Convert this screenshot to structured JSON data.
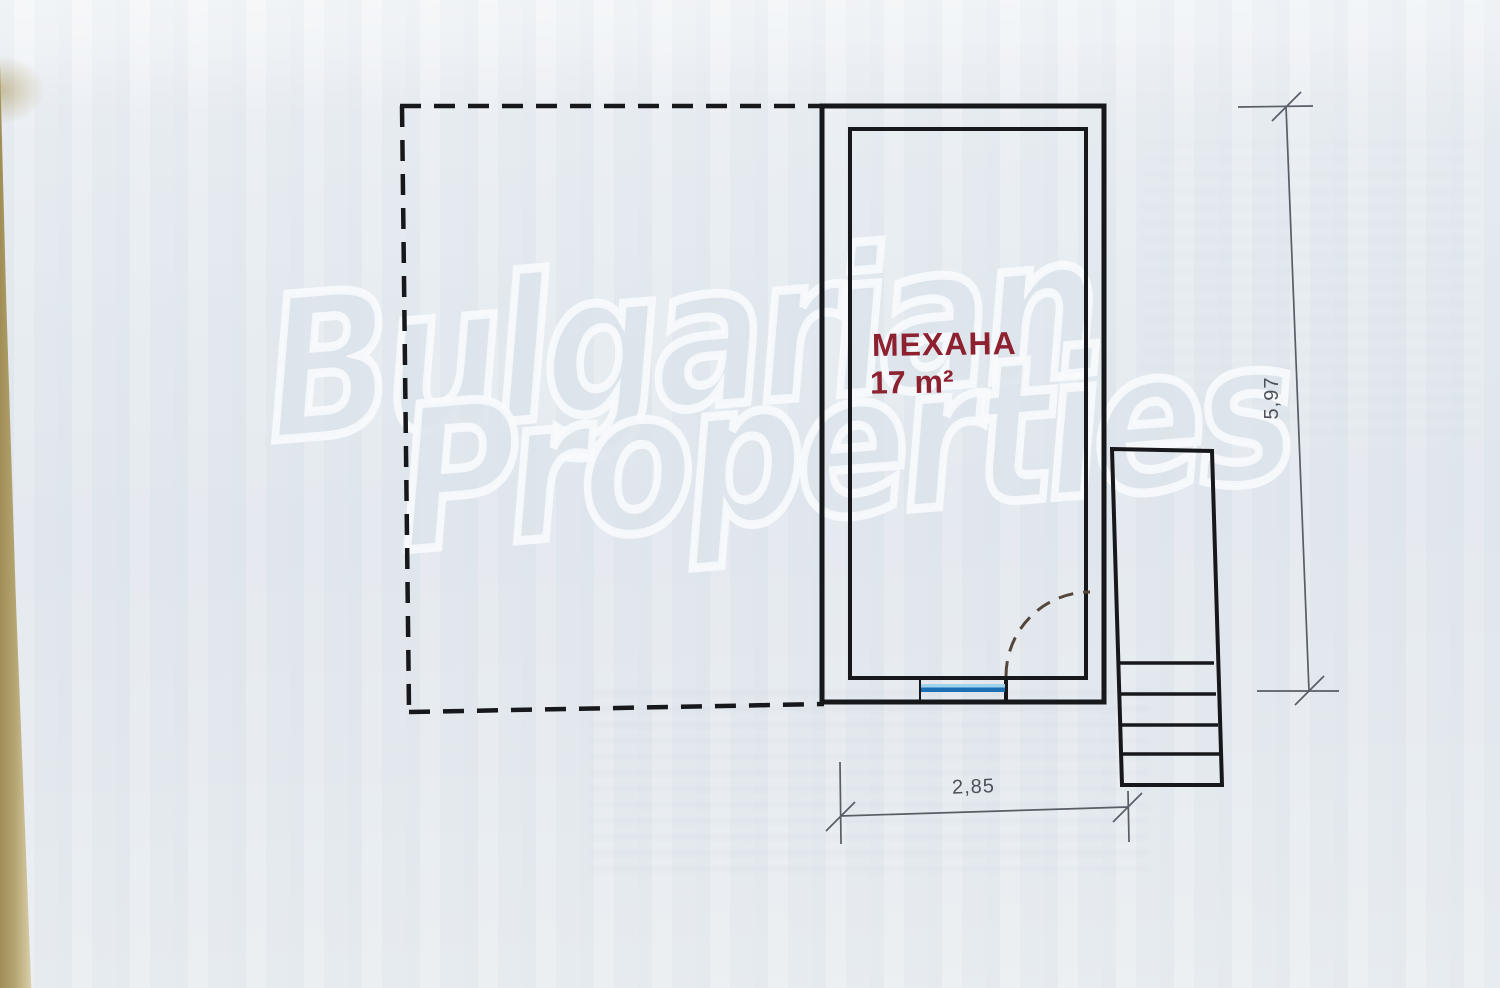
{
  "watermark": {
    "line1": "Bulgarian",
    "line2": "Properties"
  },
  "room": {
    "name": "МЕХАНА",
    "area": "17 m²"
  },
  "dimensions": {
    "width": "2,85",
    "height": "5,97"
  },
  "colors": {
    "ink": "#17181b",
    "dimension_line": "#585d66",
    "room_label": "#8d2130",
    "window_blue": "#1b6fb3",
    "window_blue_light": "#9fd3ec",
    "door_swing": "#54463a",
    "paper": "#e5ebf0",
    "paper_edge_tan": "#b5a573"
  }
}
